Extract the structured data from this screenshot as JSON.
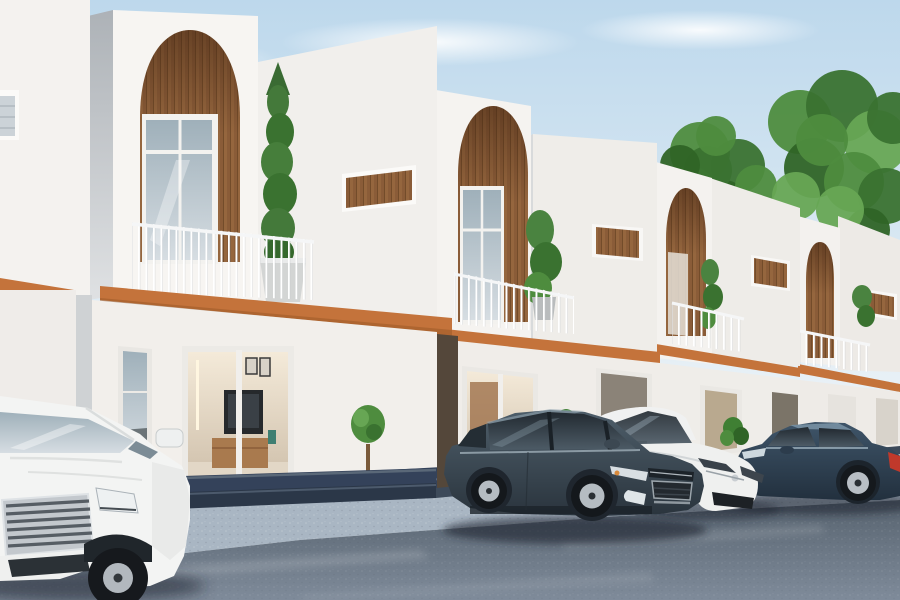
{
  "scene": {
    "title": "Modern townhouse row exterior 3D render with parked cars",
    "environment": {
      "sky_top": "#bdd8ec",
      "sky_mid": "#d7e7f2",
      "sky_bottom": "#edf3f7",
      "cloud": "#ffffff",
      "sidewalk": "#a9b6c3",
      "road_dark": "#57636f",
      "road_light": "#7f8b9a",
      "steps": "#34425a",
      "steps_dark": "#2b3748"
    },
    "palette": {
      "wall_bright": "#f6f4f1",
      "wall_soft": "#efede9",
      "wall_side": "#b5b9bd",
      "wood": "#8a5c38",
      "wood_light": "#95663e",
      "wood_dark": "#61401f",
      "accent_terracotta": "#c4733b",
      "accent_dark": "#9c5a28",
      "railing_white": "#ffffff",
      "glass_cool": "#9fb0ba",
      "interior_warm": "#e9dcc8",
      "foliage": "#4e8c3e",
      "foliage_dark": "#2f6426",
      "foliage_light": "#67a654",
      "tire": "#16191d",
      "rim_silver": "#b4bac0",
      "planter_gray": "#d3d5d4",
      "pot_terracotta": "#b07a4a"
    },
    "houses": {
      "count": 5,
      "style": "white minimalist townhouses",
      "features": [
        "arched wood-clad niche",
        "balcony with thin white railing",
        "terracotta fascia band",
        "slot window with wood infill",
        "glass sliding doors",
        "potted plants"
      ]
    },
    "vehicles": [
      {
        "name": "white-sedan-left",
        "body": "#f3f4f3",
        "position": "foreground left, front view"
      },
      {
        "name": "dark-slate-sedan-center",
        "body": "#3c4a55",
        "position": "center, three-quarter front view"
      },
      {
        "name": "white-compact-car",
        "body": "#eff0ef",
        "position": "behind center sedan, front view"
      },
      {
        "name": "dark-blue-sedan-right",
        "body": "#31445a",
        "taillight": "#c0392b",
        "position": "right, side view"
      }
    ],
    "plants": [
      {
        "name": "balcony-cypress"
      },
      {
        "name": "balcony-shrub"
      },
      {
        "name": "entry-topiary"
      },
      {
        "name": "ground-bushes"
      }
    ],
    "trees": {
      "colors": [
        "#4e8c3e",
        "#3a7230",
        "#67a654",
        "#2f6426"
      ],
      "clusters": [
        {
          "name": "tree-left",
          "blobs": [
            [
              700,
              152,
              30
            ],
            [
              738,
              166,
              27
            ],
            [
              690,
              192,
              26
            ],
            [
              724,
              204,
              24
            ],
            [
              756,
              186,
              21
            ],
            [
              708,
              170,
              24
            ],
            [
              742,
              222,
              18
            ],
            [
              680,
              165,
              20
            ],
            [
              716,
              136,
              20
            ]
          ]
        },
        {
          "name": "tree-right",
          "blobs": [
            [
              800,
              122,
              32
            ],
            [
              842,
              106,
              36
            ],
            [
              876,
              142,
              32
            ],
            [
              814,
              168,
              30
            ],
            [
              854,
              182,
              30
            ],
            [
              886,
              196,
              28
            ],
            [
              796,
              196,
              24
            ],
            [
              868,
              230,
              22
            ],
            [
              822,
              140,
              26
            ],
            [
              893,
              118,
              26
            ],
            [
              840,
              210,
              24
            ]
          ]
        }
      ]
    }
  }
}
